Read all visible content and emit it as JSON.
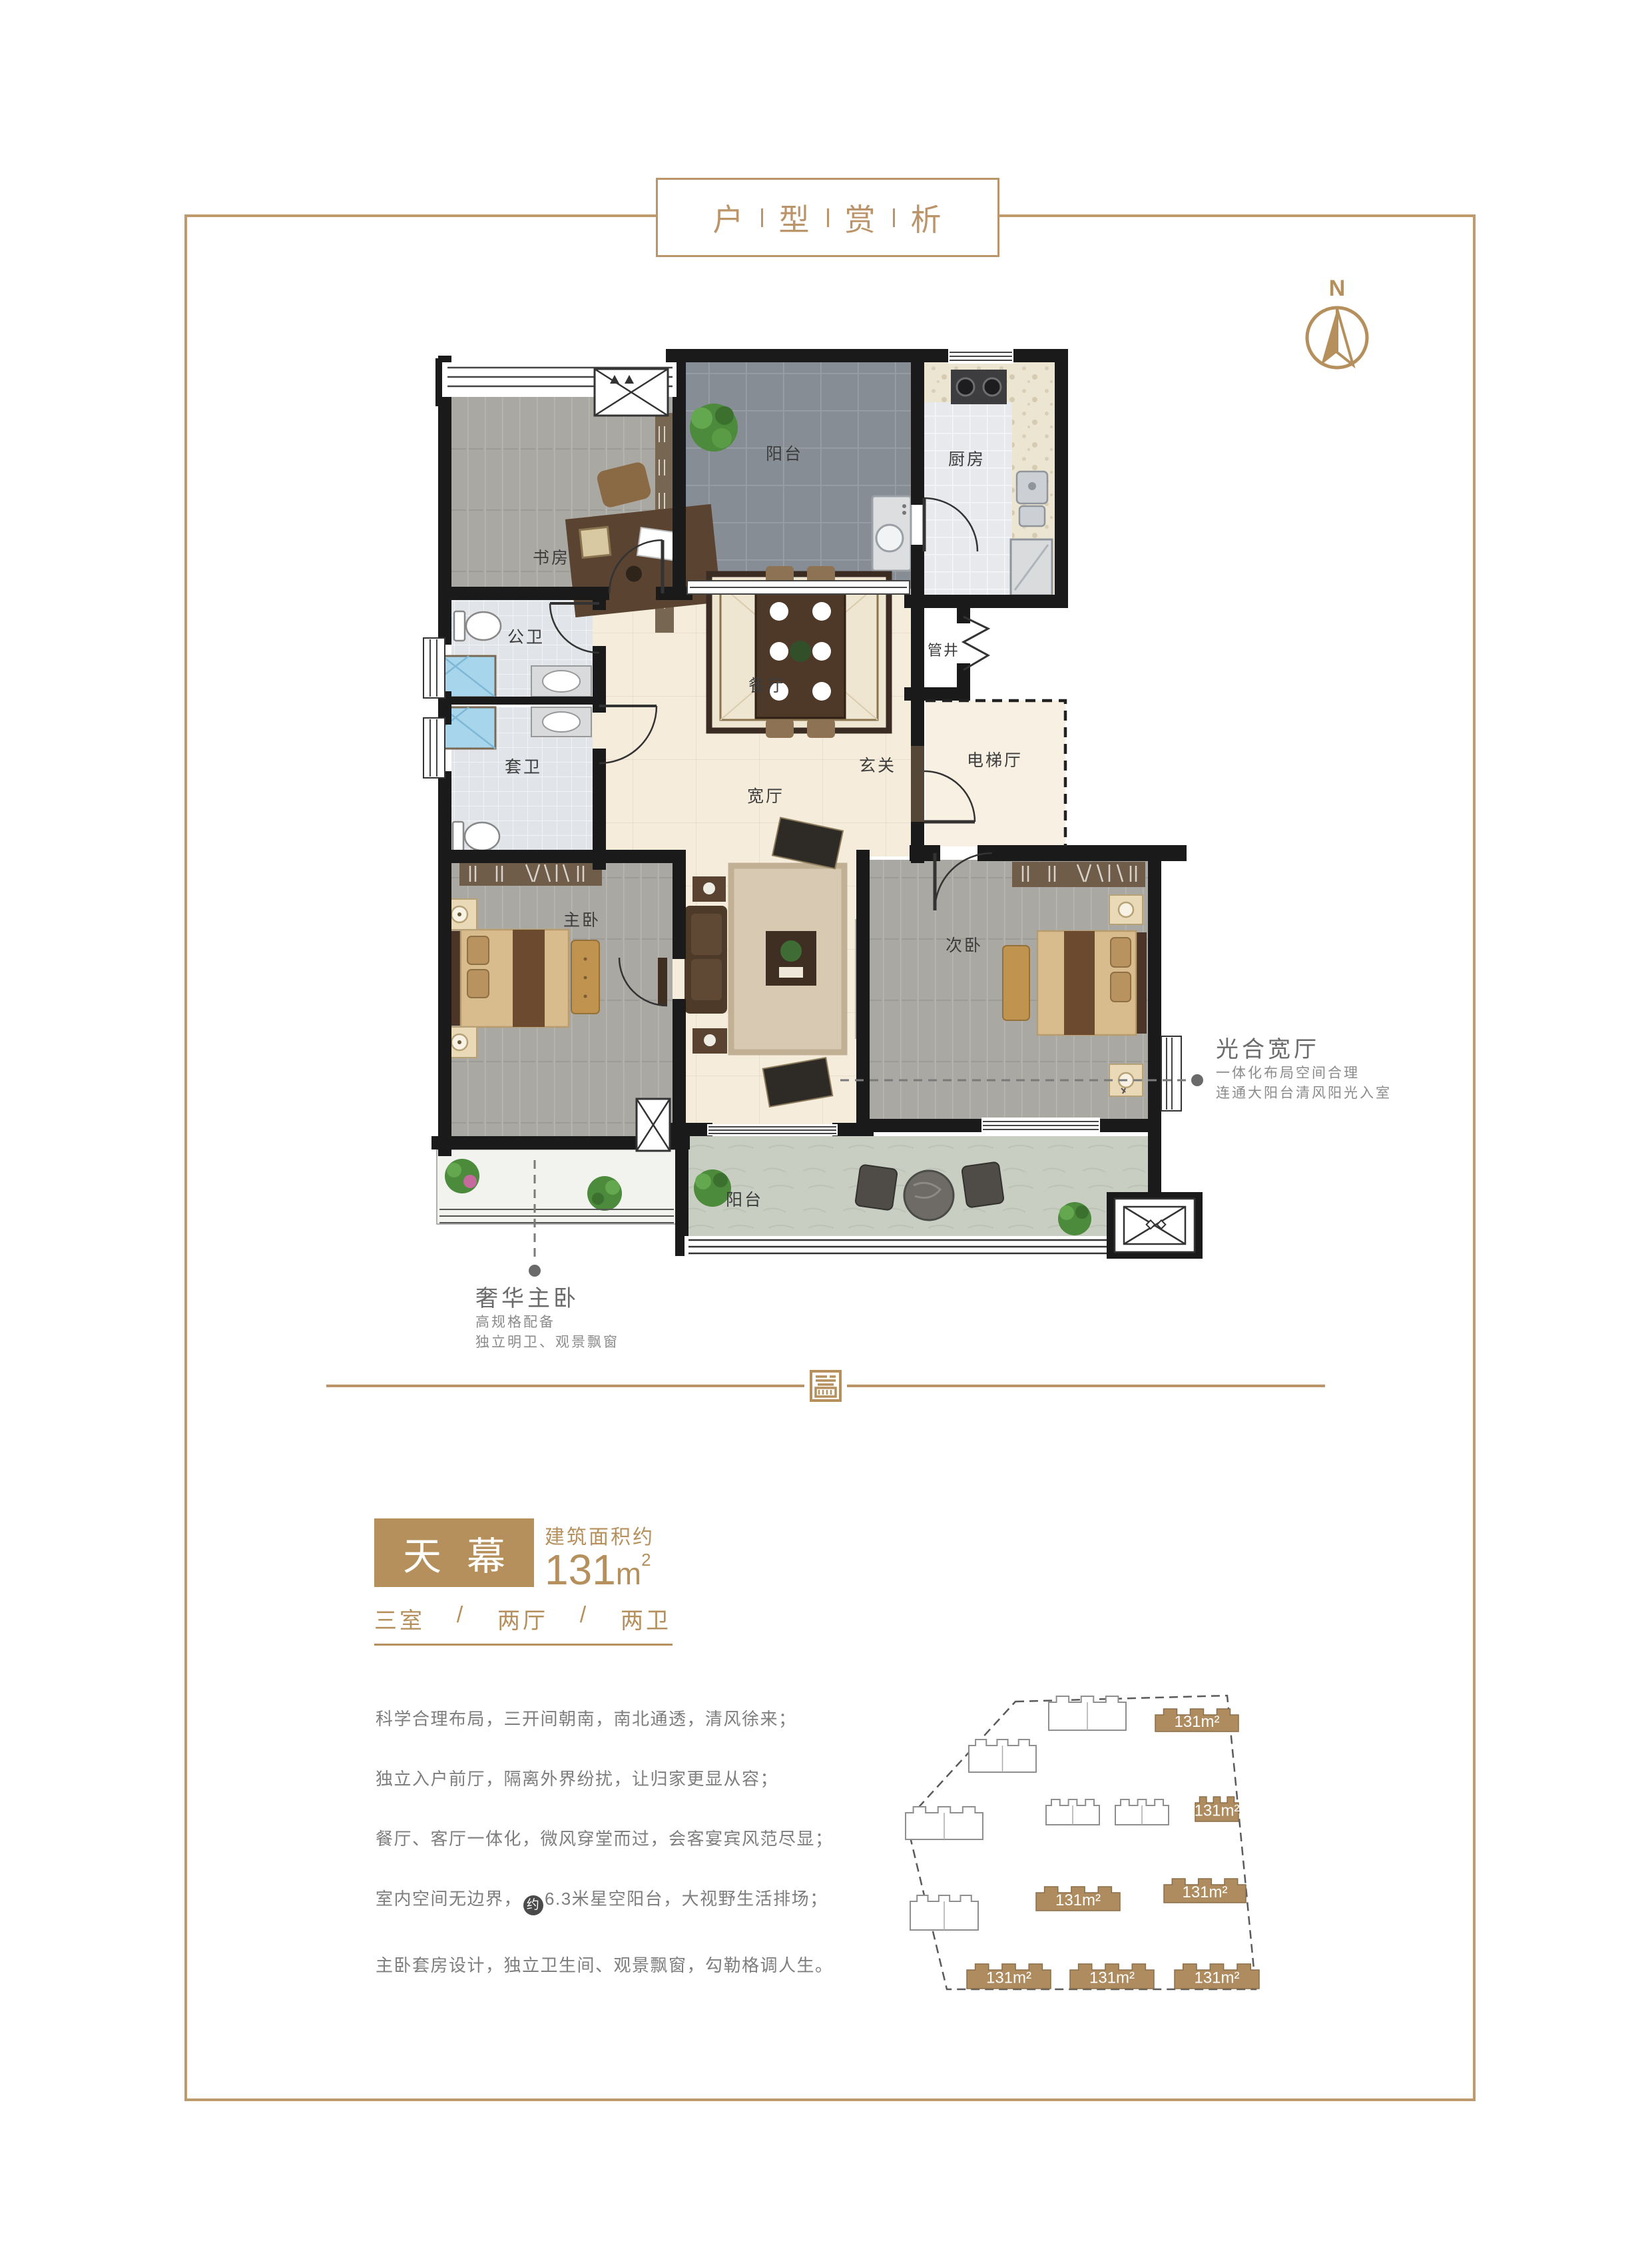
{
  "page": {
    "title_chars": [
      "户",
      "型",
      "赏",
      "析"
    ]
  },
  "compass": {
    "label": "N"
  },
  "colors": {
    "accent": "#bb9469",
    "gold": "#b5905c",
    "text_gray": "#7e7e7e"
  },
  "plan": {
    "rooms": {
      "balcony_top": "阳台",
      "kitchen": "厨房",
      "study": "书房",
      "bath_public": "公卫",
      "bath_ensuite": "套卫",
      "dining": "餐厅",
      "pipe_shaft": "管井",
      "foyer": "玄关",
      "elevator_hall": "电梯厅",
      "living": "宽厅",
      "master_bedroom": "主卧",
      "second_bedroom": "次卧",
      "balcony_bottom": "阳台"
    }
  },
  "annotations": {
    "right": {
      "title": "光合宽厅",
      "line1": "一体化布局空间合理",
      "line2": "连通大阳台清风阳光入室"
    },
    "left": {
      "title": "奢华主卧",
      "line1": "高规格配备",
      "line2": "独立明卫、观景飘窗"
    }
  },
  "unit": {
    "name": "天幕",
    "area_prefix": "建筑面积约",
    "area_number": "131",
    "area_unit": "m",
    "area_sup": "2",
    "layout_room": "三室",
    "layout_hall": "两厅",
    "layout_bath": "两卫",
    "layout_sep": "/"
  },
  "description": {
    "l1": "科学合理布局，三开间朝南，南北通透，清风徐来；",
    "l2": "独立入户前厅，隔离外界纷扰，让归家更显从容；",
    "l3": "餐厅、客厅一体化，微风穿堂而过，会客宴宾风范尽显；",
    "l4a": "室内空间无边界，",
    "l4b": "约",
    "l4c": "6.3米星空阳台，大视野生活排场；",
    "l5": "主卧套房设计，独立卫生间、观景飘窗，勾勒格调人生。"
  },
  "site_plan": {
    "area_label": "131m²"
  }
}
